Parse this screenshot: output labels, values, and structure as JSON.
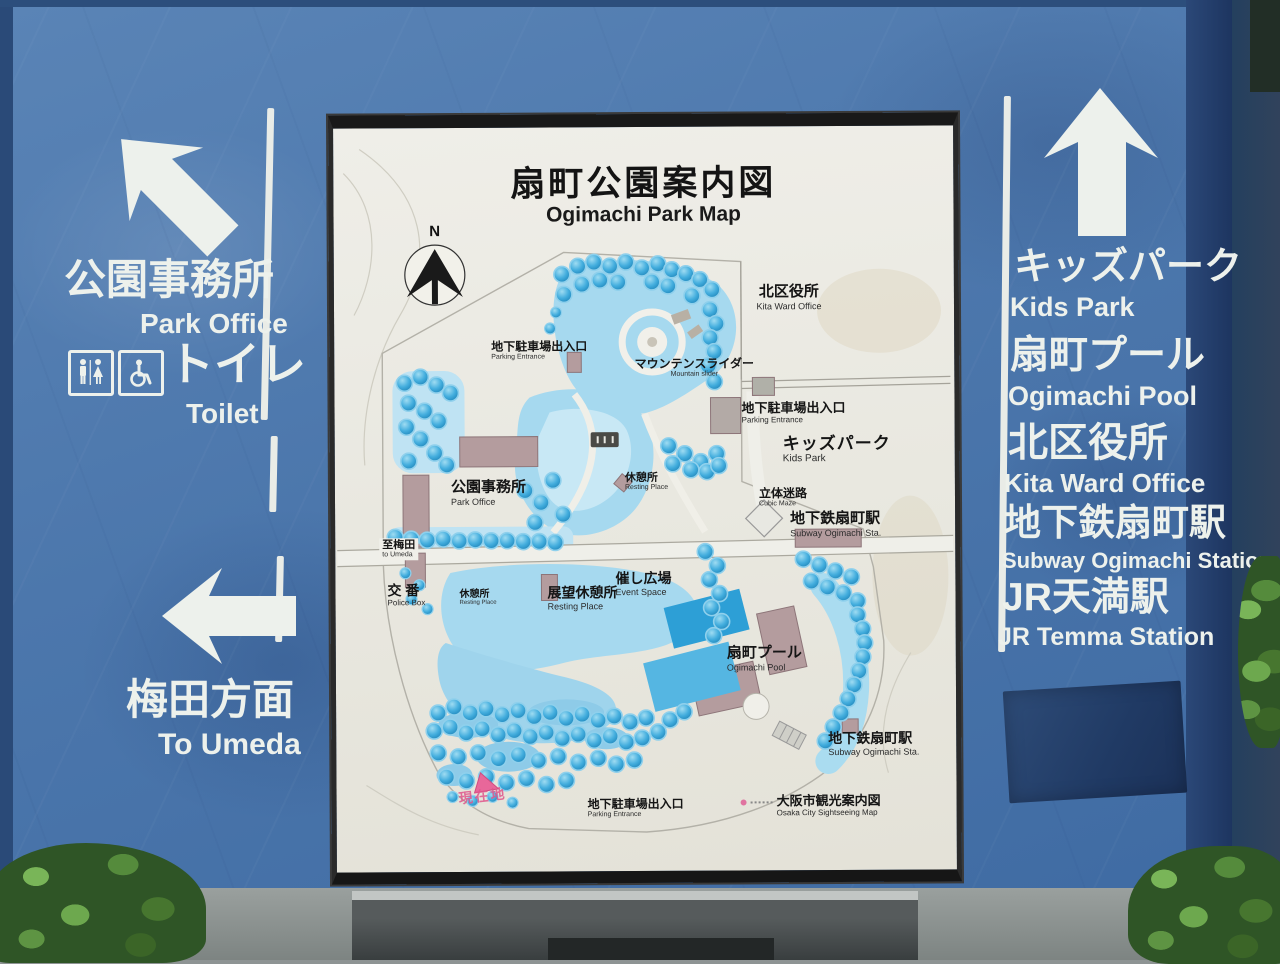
{
  "sign": {
    "title": {
      "jp": "扇町公園案内図",
      "en": "Ogimachi Park Map"
    },
    "left": {
      "park_office": {
        "jp": "公園事務所",
        "en": "Park Office"
      },
      "toilet": {
        "jp": "トイレ",
        "en": "Toilet"
      },
      "umeda": {
        "jp": "梅田方面",
        "en": "To Umeda"
      }
    },
    "right": {
      "items": [
        {
          "jp": "キッズパーク",
          "en": "Kids Park"
        },
        {
          "jp": "扇町プール",
          "en": "Ogimachi Pool"
        },
        {
          "jp": "北区役所",
          "en": "Kita Ward Office"
        },
        {
          "jp": "地下鉄扇町駅",
          "en": "Subway Ogimachi Station"
        },
        {
          "jp": "JR天満駅",
          "en": "JR Temma Station"
        }
      ]
    }
  },
  "map": {
    "compass_n": "N",
    "you_are_here": "現在地",
    "labels": [
      {
        "jp": "北区役所",
        "en": "Kita Ward Office"
      },
      {
        "jp": "地下駐車場出入口",
        "en": "Parking Entrance"
      },
      {
        "jp": "マウンテンスライダー",
        "en": "Mountain slider"
      },
      {
        "jp": "地下駐車場出入口",
        "en": "Parking Entrance"
      },
      {
        "jp": "キッズパーク",
        "en": "Kids Park"
      },
      {
        "jp": "休憩所",
        "en": "Resting Place"
      },
      {
        "jp": "公園事務所",
        "en": "Park Office"
      },
      {
        "jp": "立体迷路",
        "en": "Cubic Maze"
      },
      {
        "jp": "地下鉄扇町駅",
        "en": "Subway Ogimachi Sta."
      },
      {
        "jp": "至梅田",
        "en": "to Umeda"
      },
      {
        "jp": "交 番",
        "en": "Police Box"
      },
      {
        "jp": "休憩所",
        "en": "Resting Place"
      },
      {
        "jp": "展望休憩所",
        "en": "Resting Place"
      },
      {
        "jp": "催し広場",
        "en": "Event Space"
      },
      {
        "jp": "扇町プール",
        "en": "Ogimachi Pool"
      },
      {
        "jp": "地下鉄扇町駅",
        "en": "Subway Ogimachi Sta."
      },
      {
        "jp": "地下駐車場出入口",
        "en": "Parking Entrance"
      }
    ],
    "legend": {
      "jp": "大阪市観光案内図",
      "en": "Osaka City Sightseeing Map"
    }
  },
  "colors": {
    "board_blue": "#4c77ac",
    "panel_background": "#e9e8e0",
    "water_blue": "#a6d9ef",
    "tree_blue": "#3aa7da",
    "pool_blue": "#2d9fd6",
    "building_mauve": "#b49c9e",
    "accent_pink": "#e0568c",
    "sign_text_white": "#edf1ec"
  }
}
